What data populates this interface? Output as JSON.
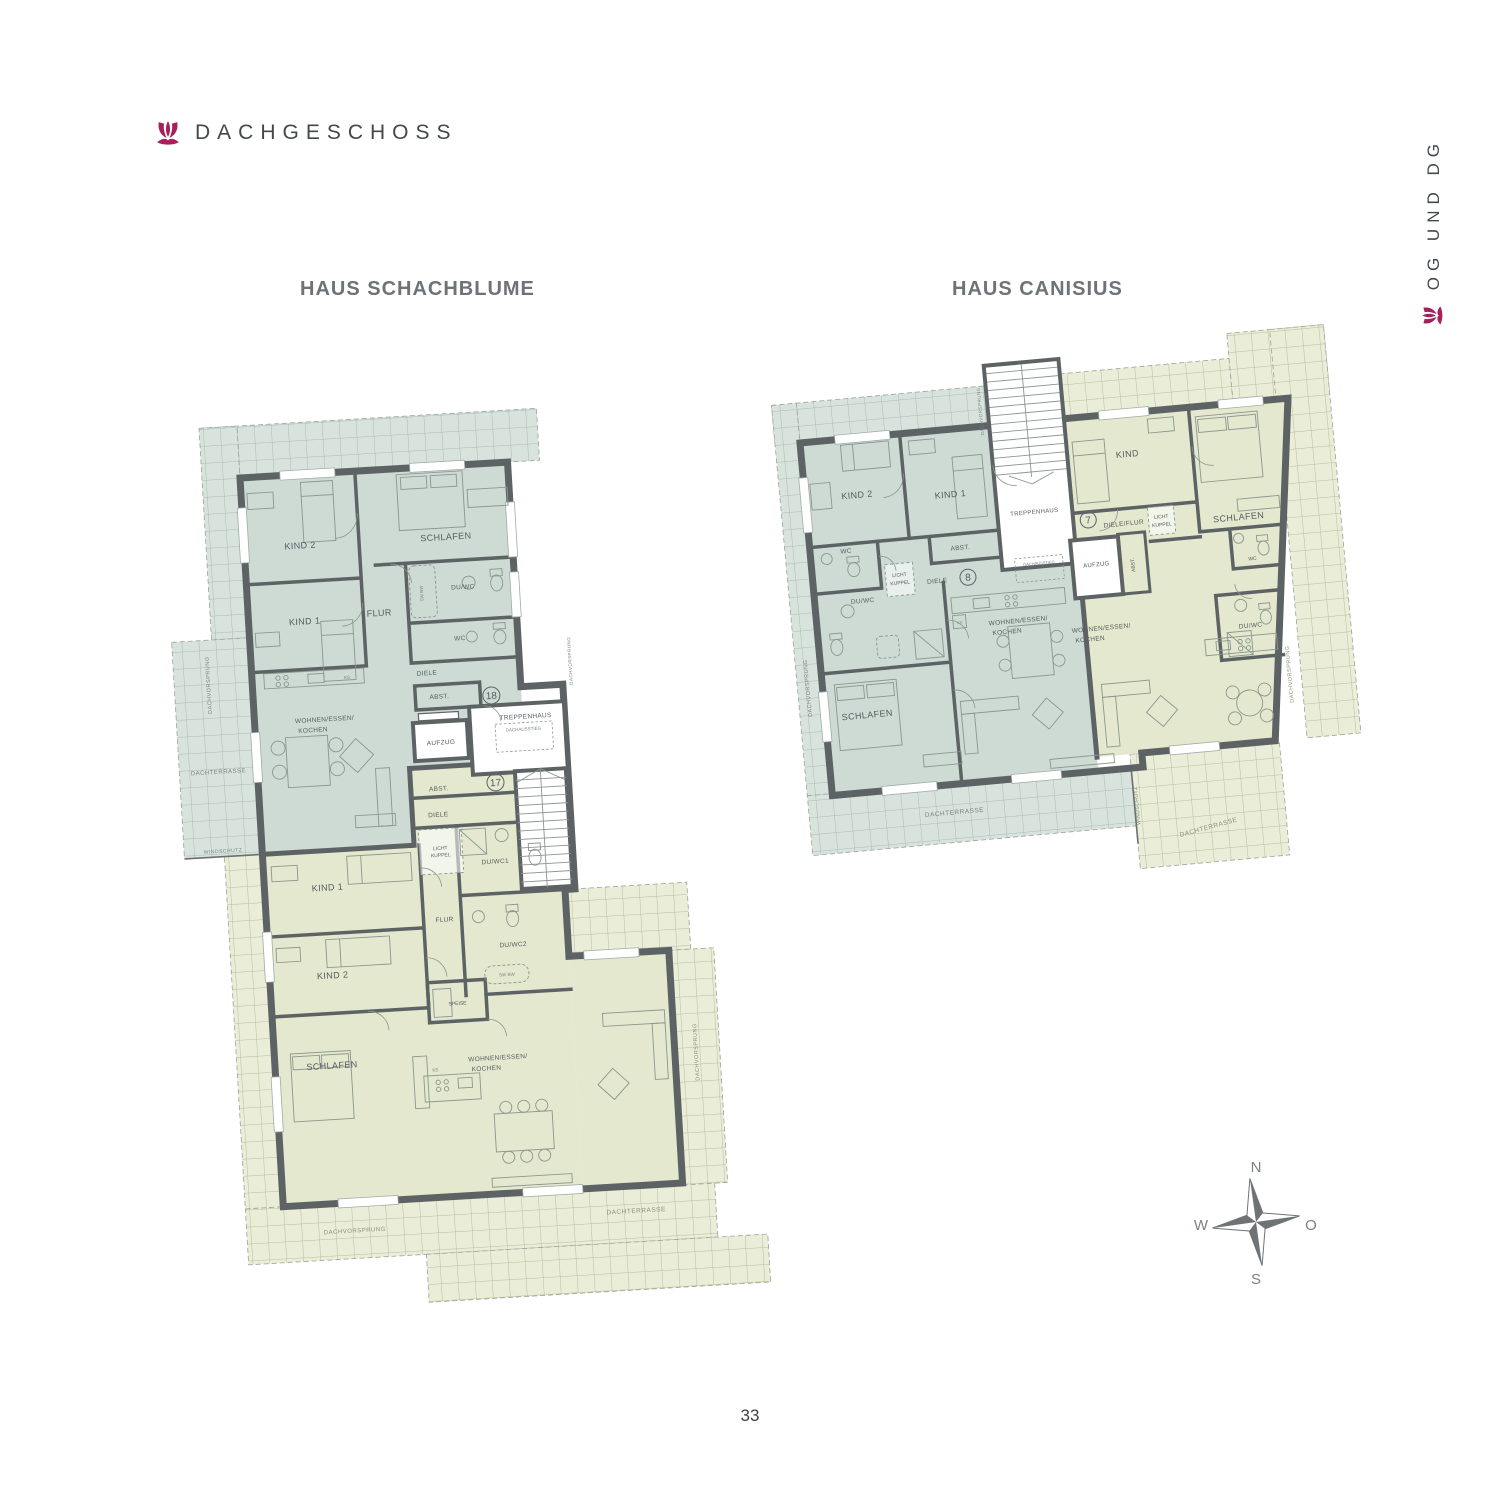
{
  "page": {
    "title": "DACHGESCHOSS",
    "side_label": "OG UND DG",
    "page_number": "33"
  },
  "compass": {
    "n": "N",
    "o": "O",
    "s": "S",
    "w": "W"
  },
  "labels": {
    "aufzug": "AUFZUG",
    "treppenhaus": "TREPPENHAUS",
    "dachausstieg": "DACHAUSSTIEG",
    "dachterrasse": "DACHTERRASSE",
    "dachvorsprung": "DACHVORSPRUNG",
    "windschutz": "WINDSCHUTZ",
    "licht1": "LICHT",
    "licht2": "KUPPEL",
    "ks": "KS",
    "swbw": "SW BW"
  },
  "schachblume": {
    "name": "HAUS SCHACHBLUME",
    "unit18": {
      "no": "18",
      "kind2": "KIND 2",
      "schlafen": "SCHLAFEN",
      "kind1": "KIND 1",
      "flur": "FLUR",
      "duwc": "DU/WC",
      "wc": "WC",
      "diele": "DIELE",
      "abst": "ABST.",
      "wohnen1": "WOHNEN/ESSEN/",
      "wohnen2": "KOCHEN"
    },
    "unit17": {
      "no": "17",
      "abst": "ABST.",
      "diele": "DIELE",
      "duwc1": "DU/WC1",
      "kind1": "KIND 1",
      "flur": "FLUR",
      "duwc2": "DU/WC2",
      "kind2": "KIND 2",
      "speise": "SPEISE",
      "schlafen": "SCHLAFEN",
      "wohnen1": "WOHNEN/ESSEN/",
      "wohnen2": "KOCHEN"
    }
  },
  "canisius": {
    "name": "HAUS CANISIUS",
    "unit8": {
      "no": "8",
      "kind2": "KIND 2",
      "kind1": "KIND 1",
      "wc": "WC",
      "abst": "ABST.",
      "diele": "DIELE",
      "duwc": "DU/WC",
      "schlafen": "SCHLAFEN",
      "wohnen1": "WOHNEN/ESSEN/",
      "wohnen2": "KOCHEN"
    },
    "unit7": {
      "no": "7",
      "kind": "KIND",
      "schlafen": "SCHLAFEN",
      "dieleflur": "DIELE/FLUR",
      "abst": "ABST.",
      "wc": "WC",
      "duwc": "DU/WC",
      "wohnen1": "WOHNEN/ESSEN/",
      "wohnen2": "KOCHEN"
    }
  },
  "colors": {
    "accent": "#a6215c",
    "wall": "#5d6365",
    "teal": "#cddbd4",
    "green": "#e3e8ce"
  }
}
